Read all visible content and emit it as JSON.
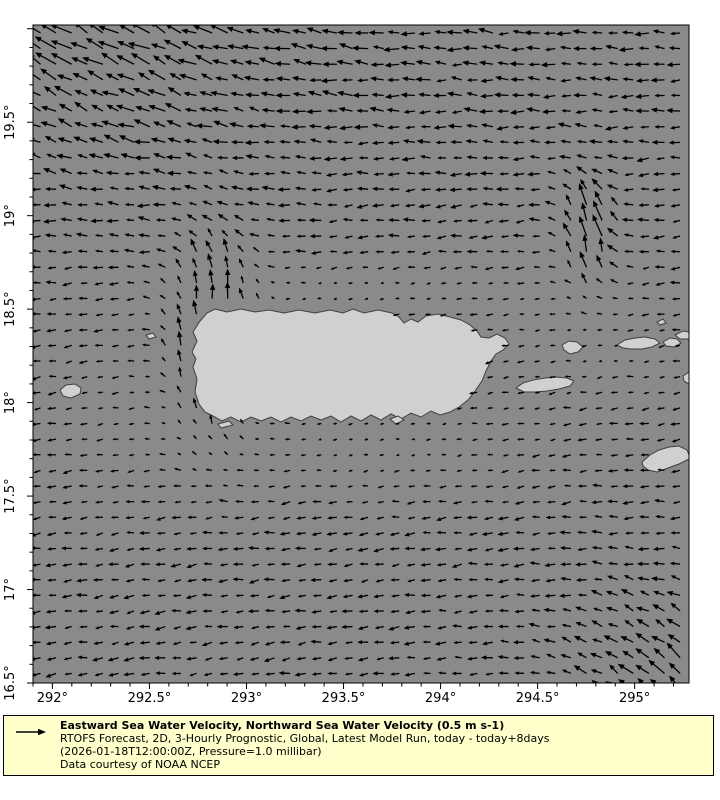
{
  "figure": {
    "width_px": 720,
    "height_px": 800,
    "colors": {
      "background": "#ffffff",
      "sea": "#8a8a8a",
      "land": "#d0d0d0",
      "coastline": "#3f3f3f",
      "arrows": "#000000",
      "axis": "#000000",
      "legend_bg": "#ffffcc",
      "legend_border": "#000000",
      "text": "#000000"
    }
  },
  "axes": {
    "plot_area_px": {
      "left": 33,
      "top": 25,
      "right": 689,
      "bottom": 683
    },
    "lon_range": [
      291.9,
      295.28
    ],
    "lat_range": [
      16.5,
      20.02
    ],
    "minor_tick_step_deg": 0.1,
    "x_major_ticks": [
      {
        "value": 292.0,
        "label": "292°"
      },
      {
        "value": 292.5,
        "label": "292.5°"
      },
      {
        "value": 293.0,
        "label": "293°"
      },
      {
        "value": 293.5,
        "label": "293.5°"
      },
      {
        "value": 294.0,
        "label": "294°"
      },
      {
        "value": 294.5,
        "label": "294.5°"
      },
      {
        "value": 295.0,
        "label": "295°"
      }
    ],
    "y_major_ticks": [
      {
        "value": 16.5,
        "label": "16.5°"
      },
      {
        "value": 17.0,
        "label": "17°"
      },
      {
        "value": 17.5,
        "label": "17.5°"
      },
      {
        "value": 18.0,
        "label": "18°"
      },
      {
        "value": 18.5,
        "label": "18.5°"
      },
      {
        "value": 19.0,
        "label": "19°"
      },
      {
        "value": 19.5,
        "label": "19.5°"
      }
    ]
  },
  "legend": {
    "title": "Eastward Sea Water Velocity, Northward Sea Water Velocity (0.5 m s-1)",
    "lines": [
      "RTOFS Forecast, 2D, 3-Hourly Prognostic, Global, Latest Model Run, today - today+8days",
      "(2026-01-18T12:00:00Z, Pressure=1.0 millibar)",
      "Data courtesy of NOAA NCEP"
    ],
    "reference_arrow": {
      "icon": "right-arrow",
      "value_m_s": 0.5
    }
  },
  "chart_data": {
    "type": "quiver-map-vector-field",
    "variables": [
      "Eastward Sea Water Velocity",
      "Northward Sea Water Velocity"
    ],
    "units": "m s-1",
    "reference_vector_m_s": 0.5,
    "region": "Puerto Rico and Virgin Islands, Mona Passage, Caribbean / Atlantic",
    "grid": {
      "x0": 40.5,
      "y0": 33,
      "dx": 15.6,
      "dy": 15.62,
      "cols": 42,
      "rows": 43
    },
    "velocity_to_px_scale": 55,
    "max_arrow_px": 30,
    "flow_features": [
      {
        "name": "caribbean-westward-drift",
        "type": "uniform",
        "u": -0.17,
        "v": -0.025
      },
      {
        "name": "atlantic-westward-band-north",
        "type": "gauss",
        "lon": 293.6,
        "slon": 3.0,
        "lat": 20.1,
        "slat": 0.9,
        "du": -0.07,
        "dv": 0.04
      },
      {
        "name": "northwest-flow-top-left",
        "type": "gauss",
        "lon": 291.8,
        "slon": 1.2,
        "lat": 20.1,
        "slat": 0.8,
        "du": -0.12,
        "dv": 0.22
      },
      {
        "name": "mona-passage-northward-jet",
        "type": "gauss",
        "lon": 292.84,
        "slon": 0.22,
        "lat": 18.35,
        "slat": 0.5,
        "du": 0.2,
        "dv": 0.6
      },
      {
        "name": "virgin-passage-northward-jet",
        "type": "gauss",
        "lon": 294.77,
        "slon": 0.15,
        "lat": 18.9,
        "slat": 0.3,
        "du": 0.08,
        "dv": 0.45
      },
      {
        "name": "southeast-northwestward-flow",
        "type": "gauss",
        "lon": 295.35,
        "slon": 0.75,
        "lat": 16.4,
        "slat": 0.65,
        "du": -0.08,
        "dv": 0.26
      },
      {
        "name": "south-coast-calm-zone",
        "type": "damp",
        "lon": 293.7,
        "slon": 0.85,
        "lat": 17.78,
        "slat": 0.28,
        "factor": 0.6
      },
      {
        "name": "north-coast-calm-zone",
        "type": "damp",
        "lon": 293.6,
        "slon": 0.95,
        "lat": 18.6,
        "slat": 0.16,
        "factor": 0.6
      },
      {
        "name": "virgin-islands-calm-zone",
        "type": "damp",
        "lon": 294.8,
        "slon": 0.55,
        "lat": 18.28,
        "slat": 0.33,
        "factor": 0.5
      },
      {
        "name": "southwest-transition-zone",
        "type": "damp",
        "lon": 292.5,
        "slon": 0.55,
        "lat": 17.95,
        "slat": 0.5,
        "factor": 0.35
      }
    ],
    "islands": [
      {
        "name": "puerto-rico",
        "points": [
          [
            192,
            352
          ],
          [
            197,
            341
          ],
          [
            193,
            332
          ],
          [
            200,
            321
          ],
          [
            207,
            313
          ],
          [
            215,
            309
          ],
          [
            227,
            312
          ],
          [
            241,
            309
          ],
          [
            255,
            312
          ],
          [
            269,
            310
          ],
          [
            284,
            313
          ],
          [
            299,
            310
          ],
          [
            315,
            313
          ],
          [
            330,
            310
          ],
          [
            343,
            313
          ],
          [
            353,
            309
          ],
          [
            364,
            313
          ],
          [
            378,
            310
          ],
          [
            392,
            313
          ],
          [
            399,
            317
          ],
          [
            404,
            323
          ],
          [
            411,
            319
          ],
          [
            418,
            322
          ],
          [
            426,
            316
          ],
          [
            438,
            314
          ],
          [
            450,
            317
          ],
          [
            461,
            320
          ],
          [
            470,
            325
          ],
          [
            477,
            331
          ],
          [
            481,
            337
          ],
          [
            489,
            338
          ],
          [
            497,
            334
          ],
          [
            505,
            338
          ],
          [
            509,
            344
          ],
          [
            503,
            350
          ],
          [
            496,
            354
          ],
          [
            491,
            361
          ],
          [
            486,
            371
          ],
          [
            482,
            381
          ],
          [
            475,
            391
          ],
          [
            468,
            400
          ],
          [
            459,
            407
          ],
          [
            450,
            412
          ],
          [
            440,
            415
          ],
          [
            431,
            411
          ],
          [
            421,
            417
          ],
          [
            411,
            413
          ],
          [
            401,
            419
          ],
          [
            391,
            414
          ],
          [
            381,
            420
          ],
          [
            371,
            415
          ],
          [
            361,
            421
          ],
          [
            351,
            416
          ],
          [
            341,
            422
          ],
          [
            331,
            416
          ],
          [
            321,
            420
          ],
          [
            311,
            416
          ],
          [
            301,
            421
          ],
          [
            291,
            417
          ],
          [
            281,
            422
          ],
          [
            271,
            417
          ],
          [
            261,
            421
          ],
          [
            251,
            417
          ],
          [
            241,
            422
          ],
          [
            231,
            417
          ],
          [
            222,
            421
          ],
          [
            213,
            416
          ],
          [
            205,
            412
          ],
          [
            199,
            404
          ],
          [
            195,
            392
          ],
          [
            197,
            379
          ],
          [
            193,
            367
          ],
          [
            196,
            359
          ]
        ]
      },
      {
        "name": "mona-island",
        "points": [
          [
            60,
            390
          ],
          [
            66,
            385
          ],
          [
            75,
            384
          ],
          [
            81,
            388
          ],
          [
            80,
            394
          ],
          [
            71,
            398
          ],
          [
            63,
            396
          ]
        ]
      },
      {
        "name": "desecheo-island",
        "points": [
          [
            146,
            335
          ],
          [
            153,
            333
          ],
          [
            156,
            337
          ],
          [
            149,
            339
          ]
        ]
      },
      {
        "name": "caja-de-muertos",
        "points": [
          [
            390,
            419
          ],
          [
            398,
            416
          ],
          [
            404,
            420
          ],
          [
            396,
            424
          ]
        ]
      },
      {
        "name": "southwest-cays",
        "points": [
          [
            218,
            424
          ],
          [
            229,
            421
          ],
          [
            233,
            425
          ],
          [
            221,
            428
          ]
        ]
      },
      {
        "name": "vieques",
        "points": [
          [
            516,
            388
          ],
          [
            523,
            383
          ],
          [
            533,
            380
          ],
          [
            545,
            378
          ],
          [
            557,
            377
          ],
          [
            567,
            378
          ],
          [
            574,
            381
          ],
          [
            570,
            386
          ],
          [
            559,
            389
          ],
          [
            547,
            391
          ],
          [
            535,
            392
          ],
          [
            524,
            392
          ]
        ]
      },
      {
        "name": "culebra",
        "points": [
          [
            562,
            345
          ],
          [
            569,
            341
          ],
          [
            577,
            342
          ],
          [
            583,
            347
          ],
          [
            578,
            352
          ],
          [
            570,
            354
          ],
          [
            564,
            350
          ]
        ]
      },
      {
        "name": "st-thomas",
        "points": [
          [
            617,
            345
          ],
          [
            625,
            340
          ],
          [
            635,
            338
          ],
          [
            645,
            337
          ],
          [
            655,
            339
          ],
          [
            660,
            343
          ],
          [
            652,
            347
          ],
          [
            642,
            349
          ],
          [
            631,
            349
          ],
          [
            623,
            348
          ]
        ]
      },
      {
        "name": "st-john",
        "points": [
          [
            663,
            342
          ],
          [
            670,
            338
          ],
          [
            677,
            339
          ],
          [
            681,
            343
          ],
          [
            674,
            347
          ],
          [
            666,
            346
          ]
        ]
      },
      {
        "name": "tortola",
        "points": [
          [
            675,
            335
          ],
          [
            683,
            331
          ],
          [
            689,
            332
          ],
          [
            689,
            339
          ],
          [
            680,
            339
          ]
        ]
      },
      {
        "name": "virgin-gorda",
        "points": [
          [
            683,
            376
          ],
          [
            689,
            372
          ],
          [
            689,
            384
          ],
          [
            684,
            381
          ]
        ]
      },
      {
        "name": "anegada-cay",
        "points": [
          [
            657,
            322
          ],
          [
            663,
            319
          ],
          [
            666,
            323
          ],
          [
            660,
            325
          ]
        ]
      },
      {
        "name": "st-croix",
        "points": [
          [
            642,
            462
          ],
          [
            650,
            455
          ],
          [
            659,
            450
          ],
          [
            669,
            447
          ],
          [
            679,
            446
          ],
          [
            687,
            450
          ],
          [
            689,
            455
          ],
          [
            689,
            459
          ],
          [
            679,
            464
          ],
          [
            668,
            468
          ],
          [
            657,
            472
          ],
          [
            648,
            470
          ],
          [
            643,
            466
          ]
        ]
      }
    ]
  }
}
